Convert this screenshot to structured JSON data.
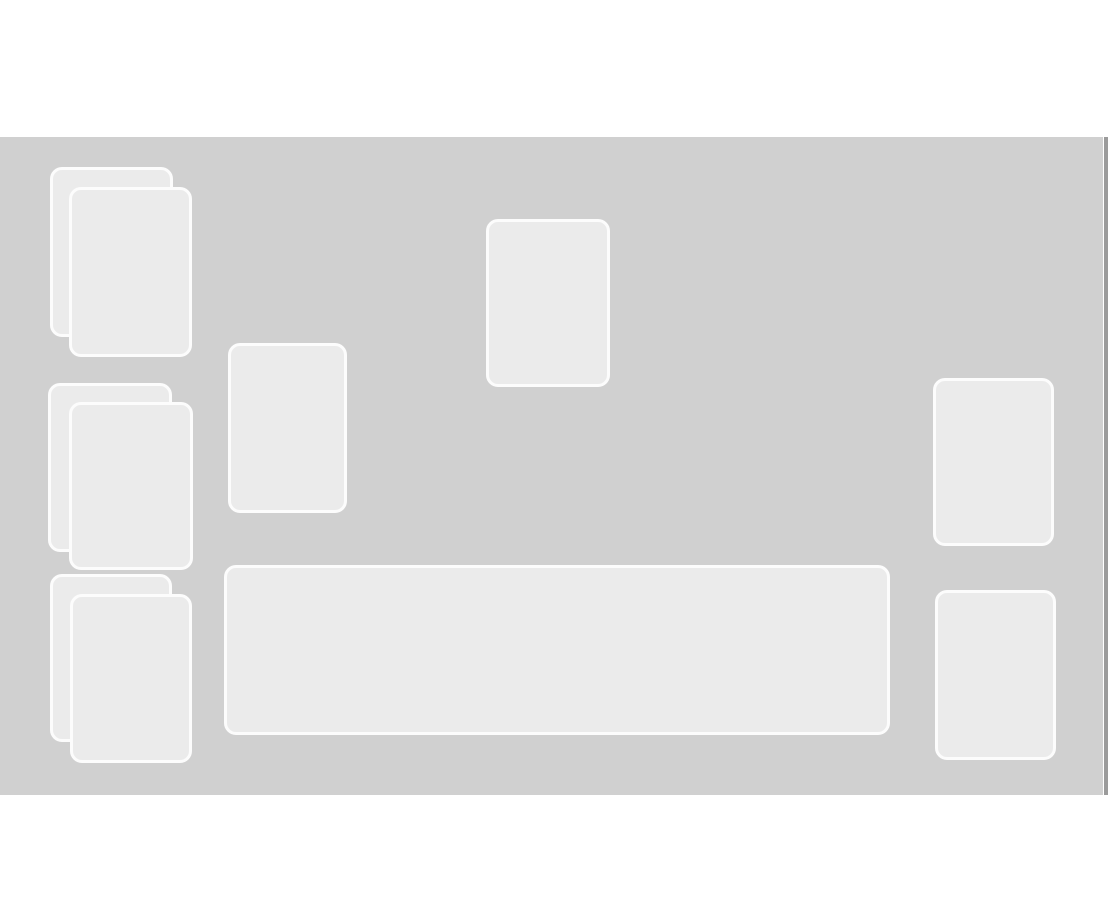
{
  "window": {
    "width": 1108,
    "height": 919
  },
  "colors": {
    "page_background": "#ffffff",
    "board_background": "#d0d0d0",
    "slot_fill": "#ebebeb",
    "slot_border": "#fcfcfc",
    "scrollbar_color": "#9b9b9b"
  },
  "board": {
    "x": 0,
    "y": 137,
    "w": 1103,
    "h": 658
  },
  "scrollbar": {
    "x": 1104,
    "y": 137,
    "w": 4,
    "h": 658
  },
  "slots": [
    {
      "name": "left-top-stack-back-card",
      "x": 50,
      "y": 167,
      "w": 123,
      "h": 170
    },
    {
      "name": "left-top-stack-front-card",
      "x": 69,
      "y": 187,
      "w": 123,
      "h": 170
    },
    {
      "name": "left-middle-stack-back-card",
      "x": 48,
      "y": 383,
      "w": 124,
      "h": 169
    },
    {
      "name": "left-middle-stack-front-card",
      "x": 69,
      "y": 402,
      "w": 124,
      "h": 168
    },
    {
      "name": "left-bottom-stack-back-card",
      "x": 50,
      "y": 574,
      "w": 122,
      "h": 168
    },
    {
      "name": "left-bottom-stack-front-card",
      "x": 70,
      "y": 594,
      "w": 122,
      "h": 169
    },
    {
      "name": "second-column-card-slot",
      "x": 228,
      "y": 343,
      "w": 119,
      "h": 170
    },
    {
      "name": "center-top-card-slot",
      "x": 486,
      "y": 219,
      "w": 124,
      "h": 168
    },
    {
      "name": "play-row-zone",
      "x": 224,
      "y": 565,
      "w": 666,
      "h": 170
    },
    {
      "name": "right-top-card-slot",
      "x": 933,
      "y": 378,
      "w": 121,
      "h": 168
    },
    {
      "name": "right-bottom-card-slot",
      "x": 935,
      "y": 590,
      "w": 121,
      "h": 170
    }
  ]
}
